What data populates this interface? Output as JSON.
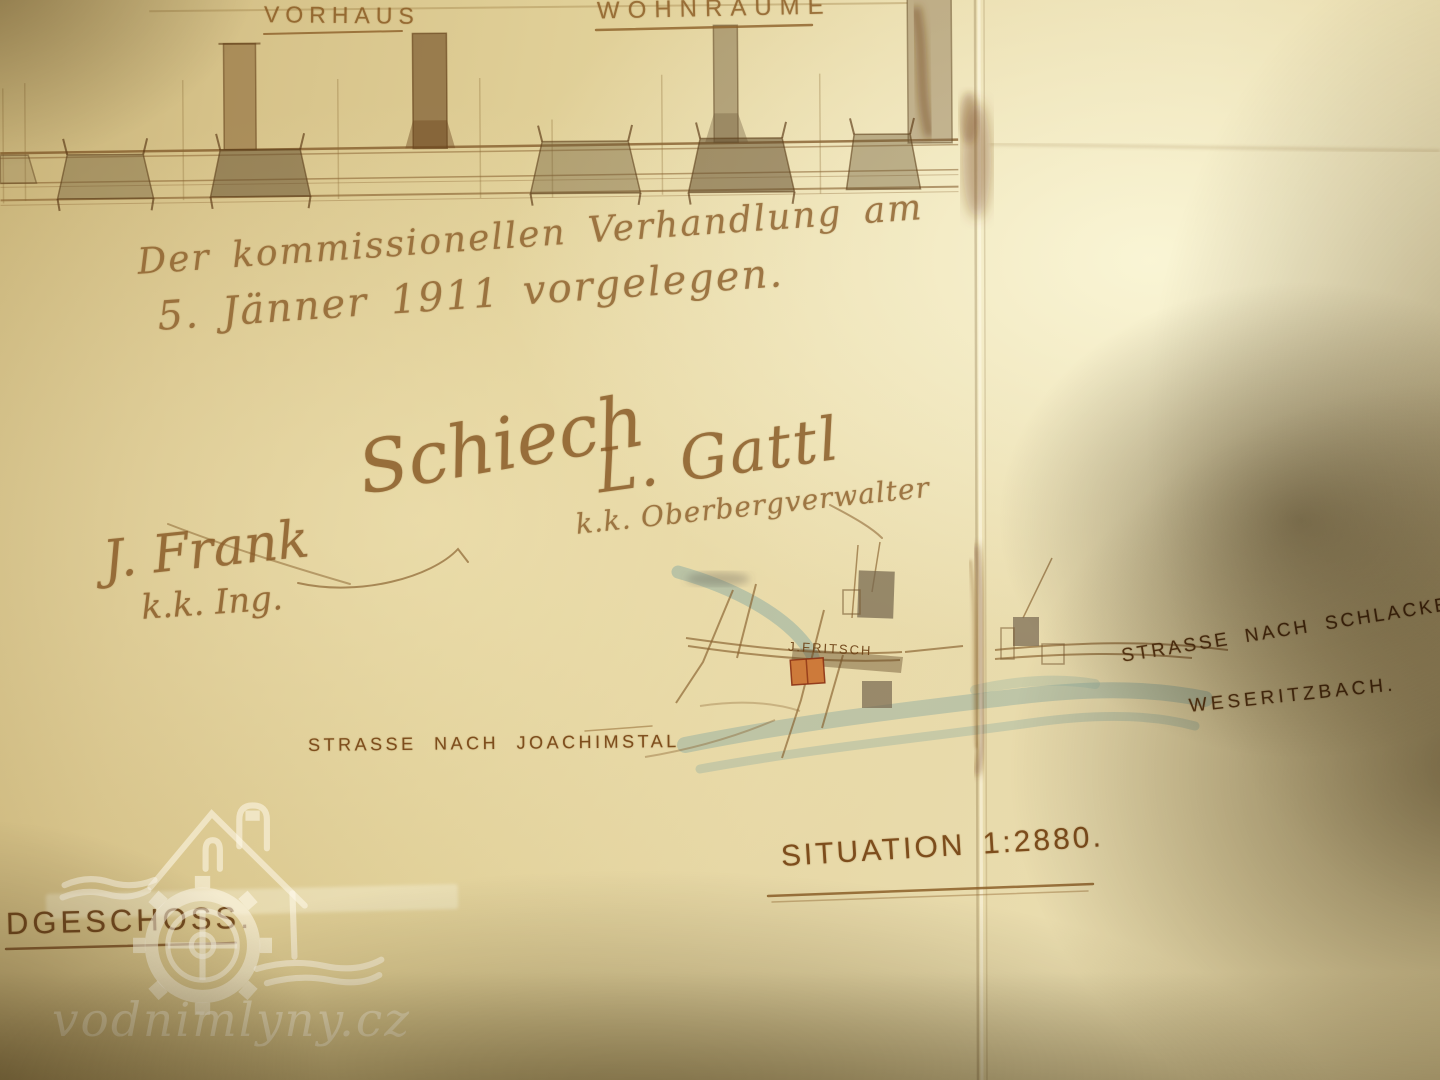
{
  "drawing": {
    "labels": [
      {
        "text": "VORHAUS"
      },
      {
        "text": "WOHNRÄUME"
      }
    ]
  },
  "handwriting": {
    "note_line1": "Der kommissionellen Verhandlung am",
    "note_line2": "5. Jänner 1911 vorgelegen.",
    "signature_schiech": "Schiech",
    "signature_gattl": "L. Gattl",
    "signature_gattl_title": "k.k. Oberbergverwalter",
    "signature_frank": "J. Frank",
    "signature_frank_title": "k.k. Ing."
  },
  "map": {
    "owner_label": "J.FRITSCH",
    "road_left_label": "STRASSE NACH JOACHIMSTAL",
    "road_right_label": "STRASSE NACH SCHLACKENW",
    "stream_label": "WESERITZBACH.",
    "title": "SITUATION 1:2880."
  },
  "plan": {
    "floor_label": "DGESCHOSS."
  },
  "watermark": {
    "site": "vodnimlyny.cz"
  },
  "colors": {
    "paper": "#e8d9a8",
    "ink_sepia": "#8a5a22",
    "mill_highlight": "#cd7a3a",
    "stream_blue": "#91b3a8"
  }
}
